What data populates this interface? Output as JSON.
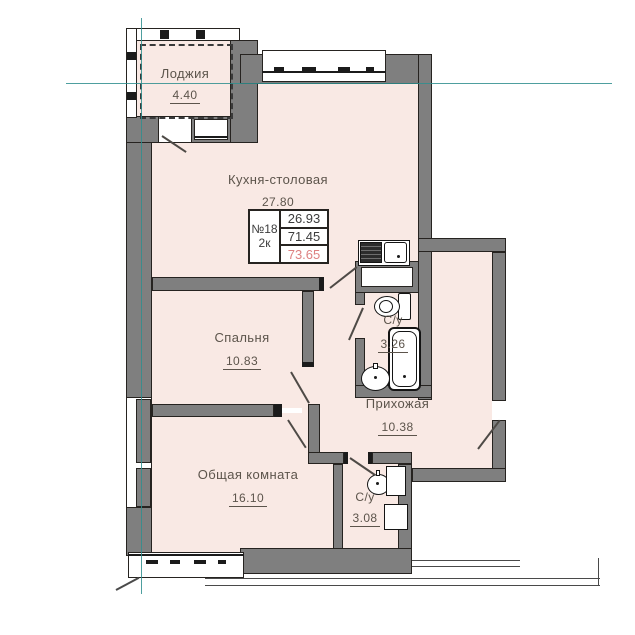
{
  "plan": {
    "rooms": {
      "loggia": {
        "label": "Лоджия",
        "area": "4.40"
      },
      "kitchen": {
        "label": "Кухня-столовая",
        "area": "27.80"
      },
      "bedroom": {
        "label": "Спальня",
        "area": "10.83"
      },
      "bath_main": {
        "label": "С/у",
        "area": "3.26"
      },
      "hallway": {
        "label": "Прихожая",
        "area": "10.38"
      },
      "living": {
        "label": "Общая комната",
        "area": "16.10"
      },
      "bath_guest": {
        "label": "С/у",
        "area": "3.08"
      }
    },
    "unit_info": {
      "number": "№18",
      "type": "2к",
      "living_area": "26.93",
      "area_without_loggia": "71.45",
      "total_area": "73.65"
    },
    "colors": {
      "room_fill": "#f9e9e4",
      "wall_gray": "#7f7f7f",
      "axis_teal": "#2f8e8e",
      "accent_red": "#de8181"
    }
  }
}
